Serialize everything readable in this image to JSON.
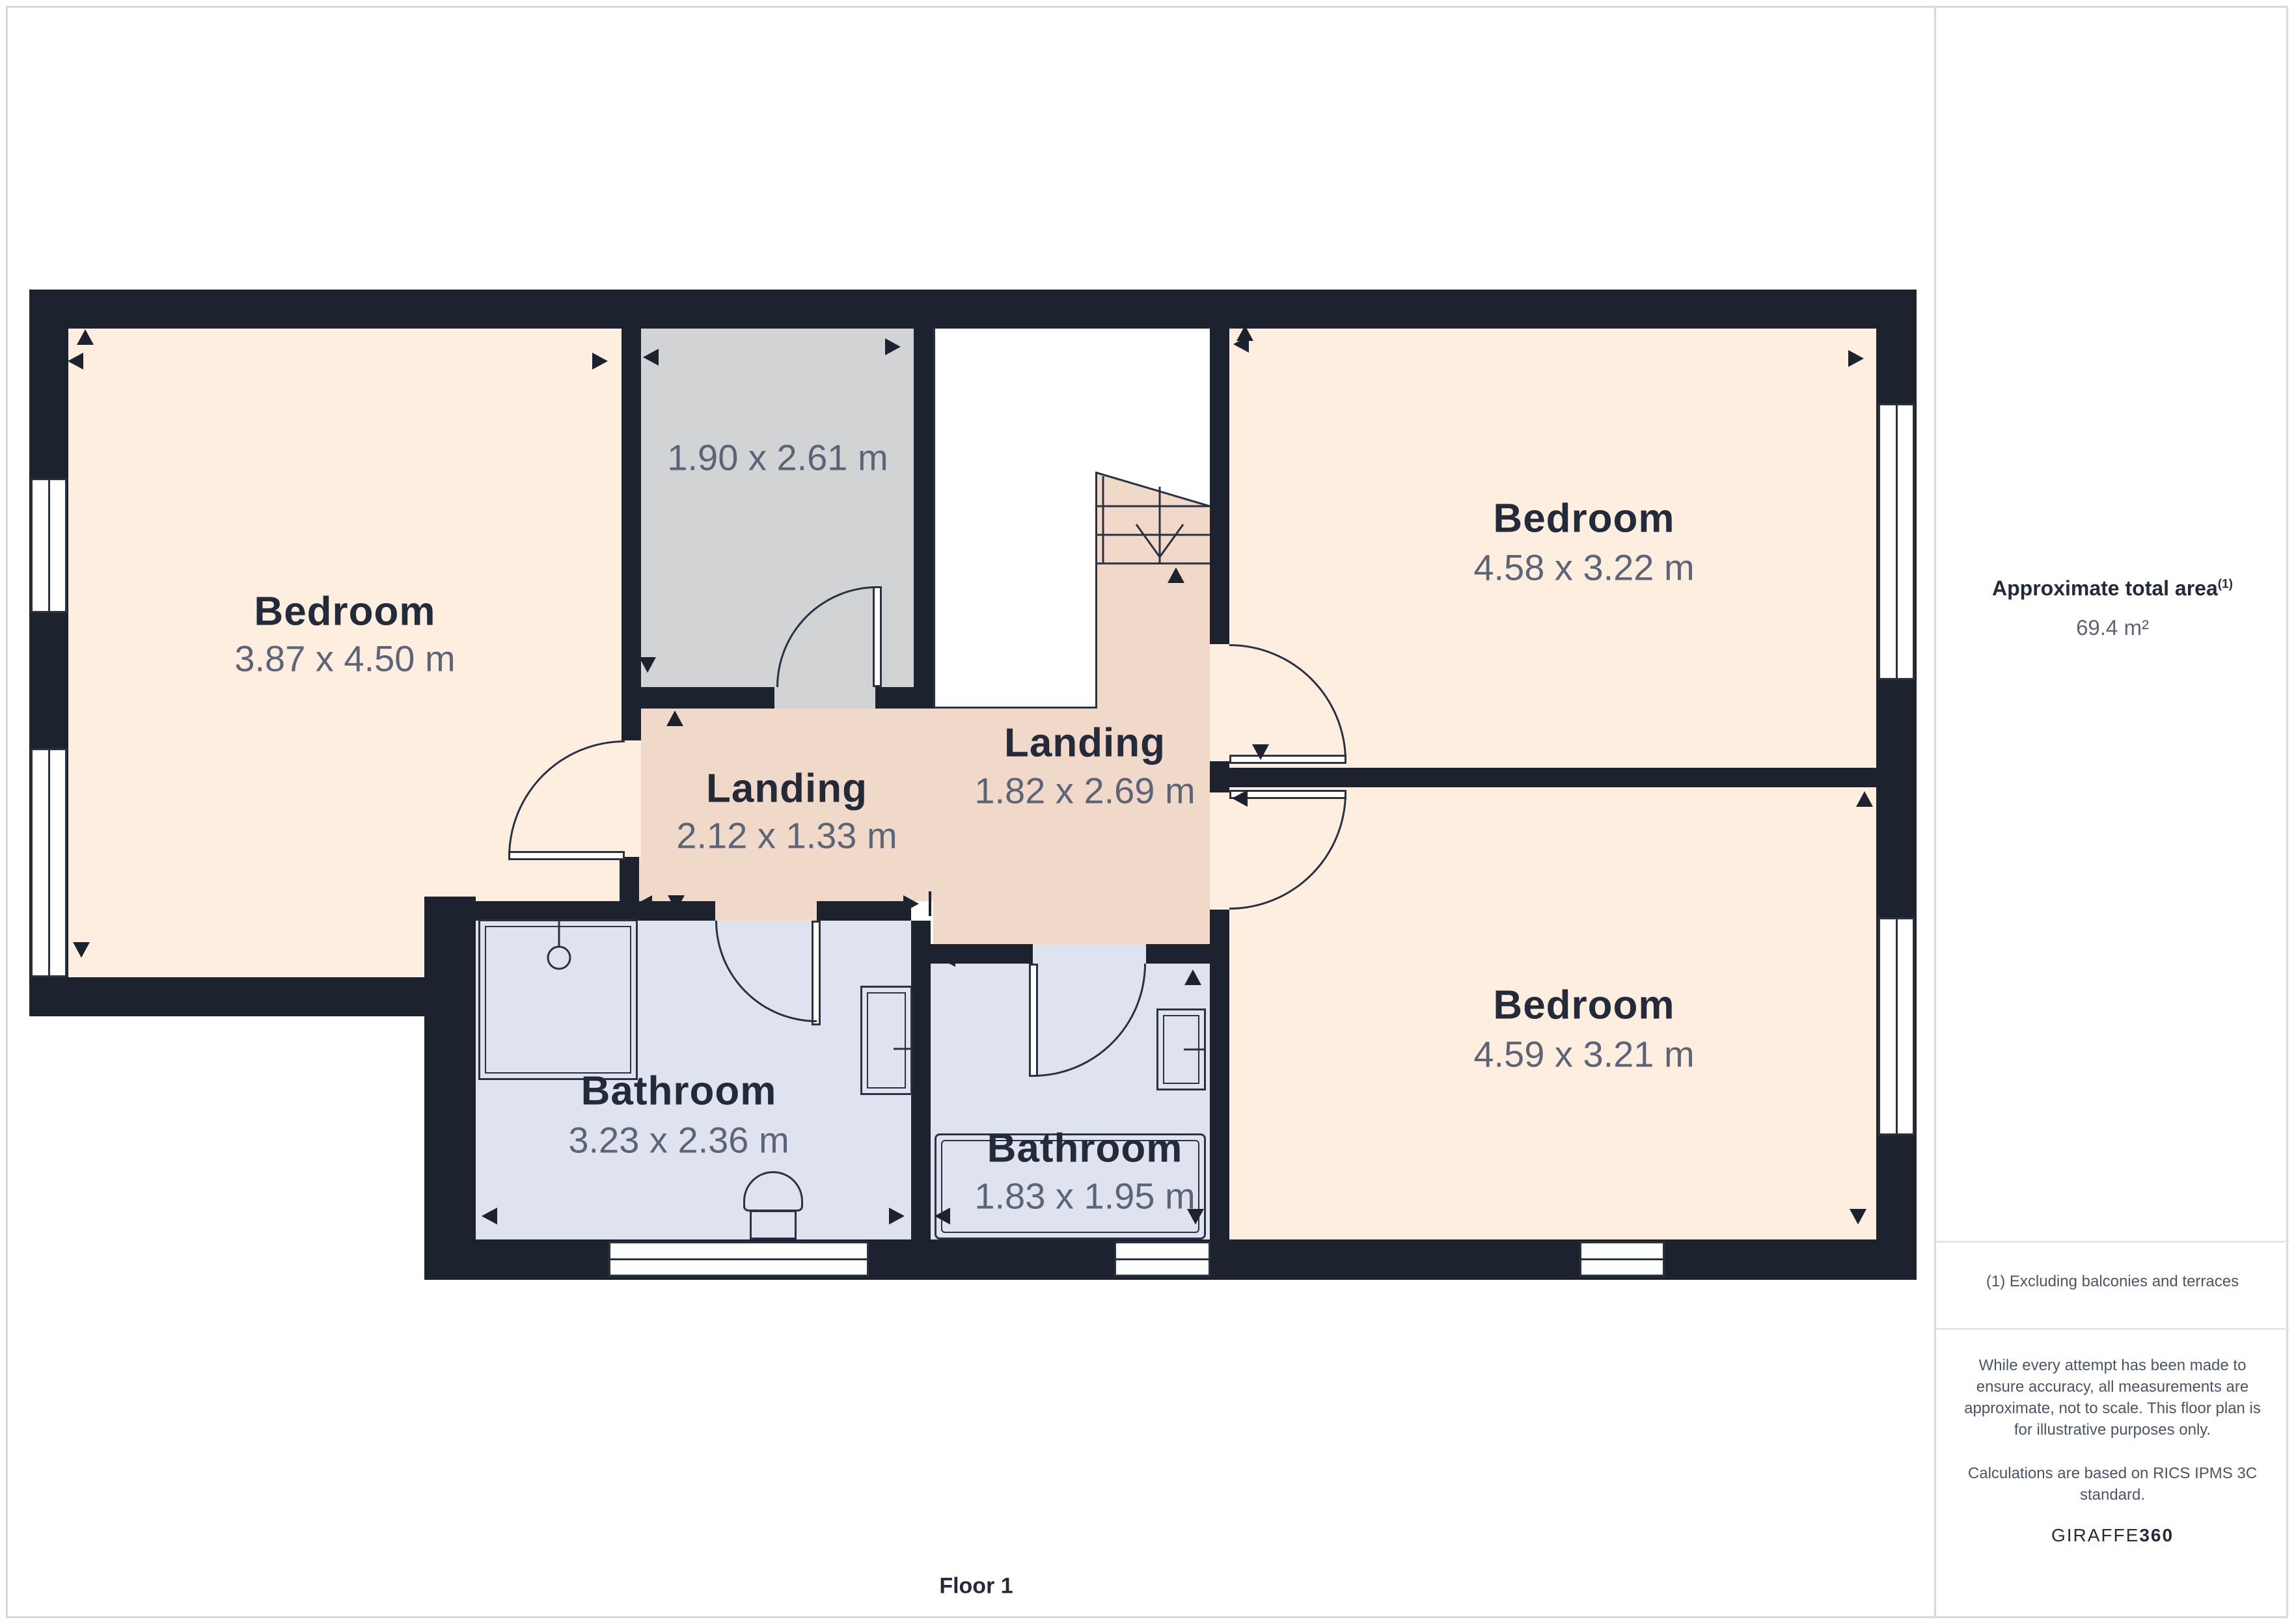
{
  "page": {
    "floor_label": "Floor 1"
  },
  "sidebar": {
    "title": "Approximate total area",
    "title_sup": "(1)",
    "area_value": "69.4 m²",
    "footnote": "(1) Excluding balconies and terraces",
    "disclaimer": "While every attempt has been made to ensure accuracy, all measurements are approximate, not to scale. This floor plan is for illustrative purposes only.",
    "standard_note": "Calculations are based on RICS IPMS 3C standard.",
    "logo_prefix": "GIRAFFE",
    "logo_suffix": "360"
  },
  "rooms": {
    "bedroom_left": {
      "name": "Bedroom",
      "dims": "3.87 x 4.50 m"
    },
    "store_gray": {
      "dims": "1.90 x 2.61 m"
    },
    "landing_small": {
      "name": "Landing",
      "dims": "2.12 x 1.33 m"
    },
    "landing_large": {
      "name": "Landing",
      "dims": "1.82 x 2.69 m"
    },
    "bedroom_top_right": {
      "name": "Bedroom",
      "dims": "4.58 x 3.22 m"
    },
    "bedroom_bottom_right": {
      "name": "Bedroom",
      "dims": "4.59 x 3.21 m"
    },
    "bathroom_left": {
      "name": "Bathroom",
      "dims": "3.23 x 2.36 m"
    },
    "bathroom_right": {
      "name": "Bathroom",
      "dims": "1.83 x 1.95 m"
    }
  },
  "colors": {
    "wall": "#1c222e",
    "room_cream": "#fdeee0",
    "room_gray": "#d2d3d5",
    "landing_pink": "#f1d9c9",
    "bathroom_blue": "#dee3ef",
    "text_primary": "#232b3a",
    "text_secondary": "#5b6577",
    "page_border": "#d9d9d9"
  }
}
